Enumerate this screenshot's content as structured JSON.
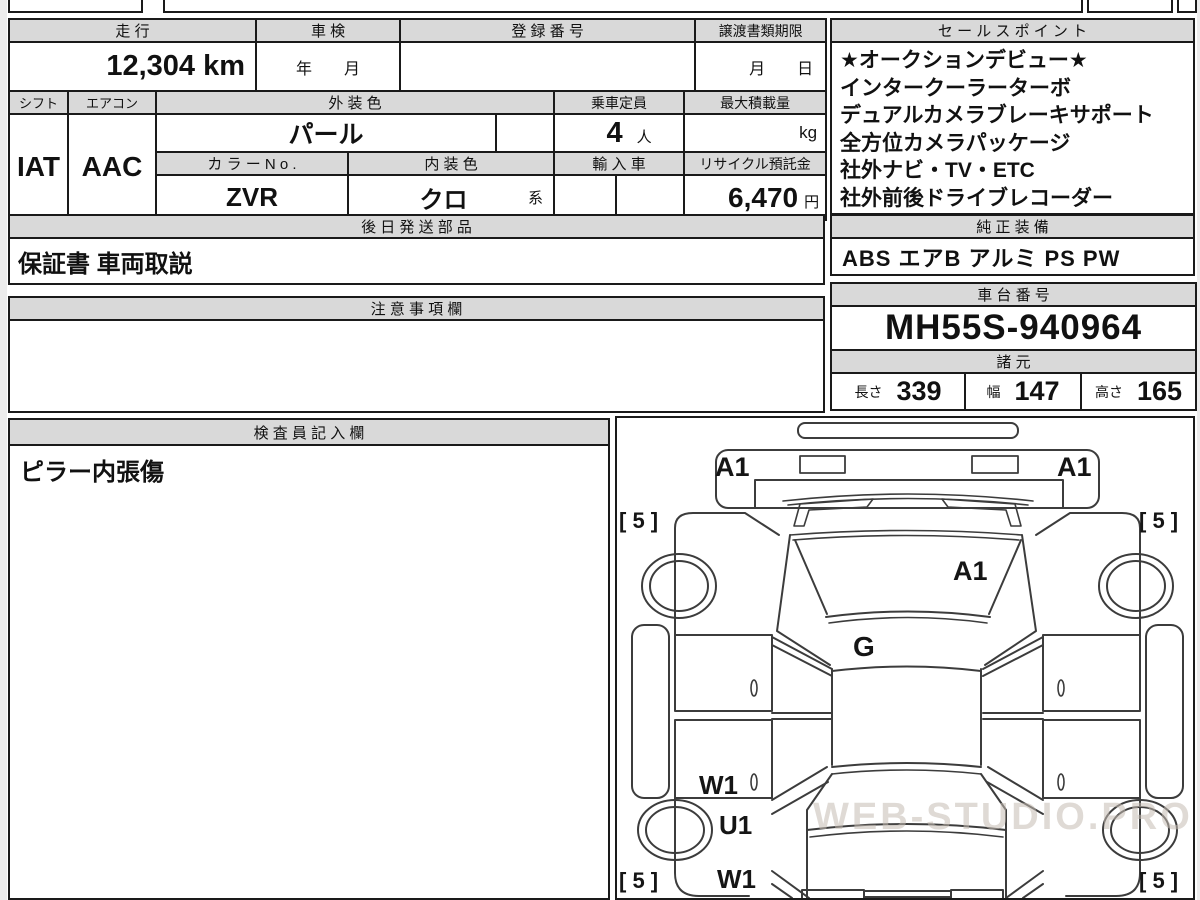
{
  "colors": {
    "border": "#1a1a1a",
    "header_bg": "#d9d9d9",
    "paper": "#ffffff"
  },
  "main_table": {
    "headers": {
      "mileage": "走 行",
      "inspection": "車 検",
      "registration": "登 録 番 号",
      "transfer_deadline": "譲渡書類期限",
      "shift": "シフト",
      "aircon": "エアコン",
      "exterior_color": "外 装 色",
      "capacity": "乗車定員",
      "max_load": "最大積載量",
      "color_no": "カ ラ ー N o .",
      "interior_color": "内 装 色",
      "import_car": "輸 入 車",
      "recycle_deposit": "リサイクル預託金"
    },
    "values": {
      "mileage": "12,304 km",
      "inspection_placeholder": "年　　月",
      "registration": "",
      "deadline_placeholder": "月　　日",
      "shift": "IAT",
      "aircon": "AAC",
      "exterior_color": "パール",
      "capacity_value": "4",
      "capacity_unit": "人",
      "max_load_unit": "kg",
      "color_no": "ZVR",
      "interior_color": "クロ",
      "interior_suffix": "系",
      "recycle_value": "6,470",
      "recycle_unit": "円"
    }
  },
  "sales_point": {
    "header": "セ ー ル ス ポ イ ン ト",
    "lines": [
      "★オークションデビュー★",
      "インタークーラーターボ",
      "デュアルカメラブレーキサポート",
      "全方位カメラパッケージ",
      "社外ナビ・TV・ETC",
      "社外前後ドライブレコーダー"
    ]
  },
  "later_shipped_parts": {
    "header": "後 日 発 送 部 品",
    "content": "保証書 車両取説"
  },
  "genuine_equipment": {
    "header": "純 正 装 備",
    "content": "ABS エアB アルミ PS PW"
  },
  "notes": {
    "header": "注 意 事 項 欄",
    "content": ""
  },
  "chassis": {
    "header": "車 台 番 号",
    "number": "MH55S-940964"
  },
  "specs": {
    "header": "諸 元",
    "length_label": "長さ",
    "length_value": "339",
    "width_label": "幅",
    "width_value": "147",
    "height_label": "高さ",
    "height_value": "165"
  },
  "inspector": {
    "header": "検 査 員 記 入 欄",
    "content": "ピラー内張傷"
  },
  "diagram": {
    "labels": {
      "a1_front_left": "A1",
      "a1_front_right": "A1",
      "a1_hood": "A1",
      "g_hood": "G",
      "w1_upper": "W1",
      "u1_rear": "U1",
      "w1_lower": "W1",
      "tread_tl": "[ 5 ]",
      "tread_tr": "[ 5 ]",
      "tread_bl": "[ 5 ]",
      "tread_br": "[ 5 ]"
    },
    "watermark": "WEB-STUDIO.PRO"
  }
}
